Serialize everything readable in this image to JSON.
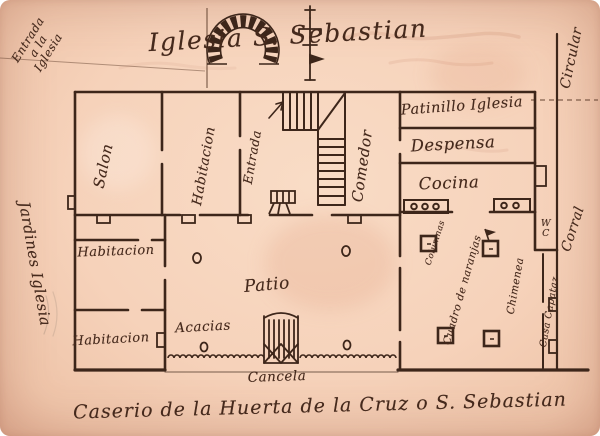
{
  "title": "Iglesia S. Sebastian",
  "caption": "Caserio de la Huerta de la Cruz o S. Sebastian",
  "margin_notes": {
    "entrada_iglesia": "Entrada a la Iglesia",
    "circular": "Circular",
    "jardines_iglesia": "Jardines Iglesia",
    "corral": "Corral"
  },
  "rooms": {
    "salon": "Salon",
    "habitacion_top": "Habitacion",
    "entrada": "Entrada",
    "comedor": "Comedor",
    "patinillo_iglesia": "Patinillo Iglesia",
    "despensa": "Despensa",
    "cocina": "Cocina",
    "habitacion_mid": "Habitacion",
    "habitacion_bot": "Habitacion",
    "wc_line1": "W",
    "wc_line2": "C",
    "casa_capataz": "Casa Capataz"
  },
  "patio": {
    "patio": "Patio",
    "acacias": "Acacias",
    "cancela": "Cancela",
    "columnas": "Columnas",
    "naranjas": "Cuadro de naranjas",
    "chimenea": "Chimenea"
  },
  "colors": {
    "paper": "#f6d2ba",
    "ink": "#45291c",
    "ghost": "#b2604a"
  }
}
